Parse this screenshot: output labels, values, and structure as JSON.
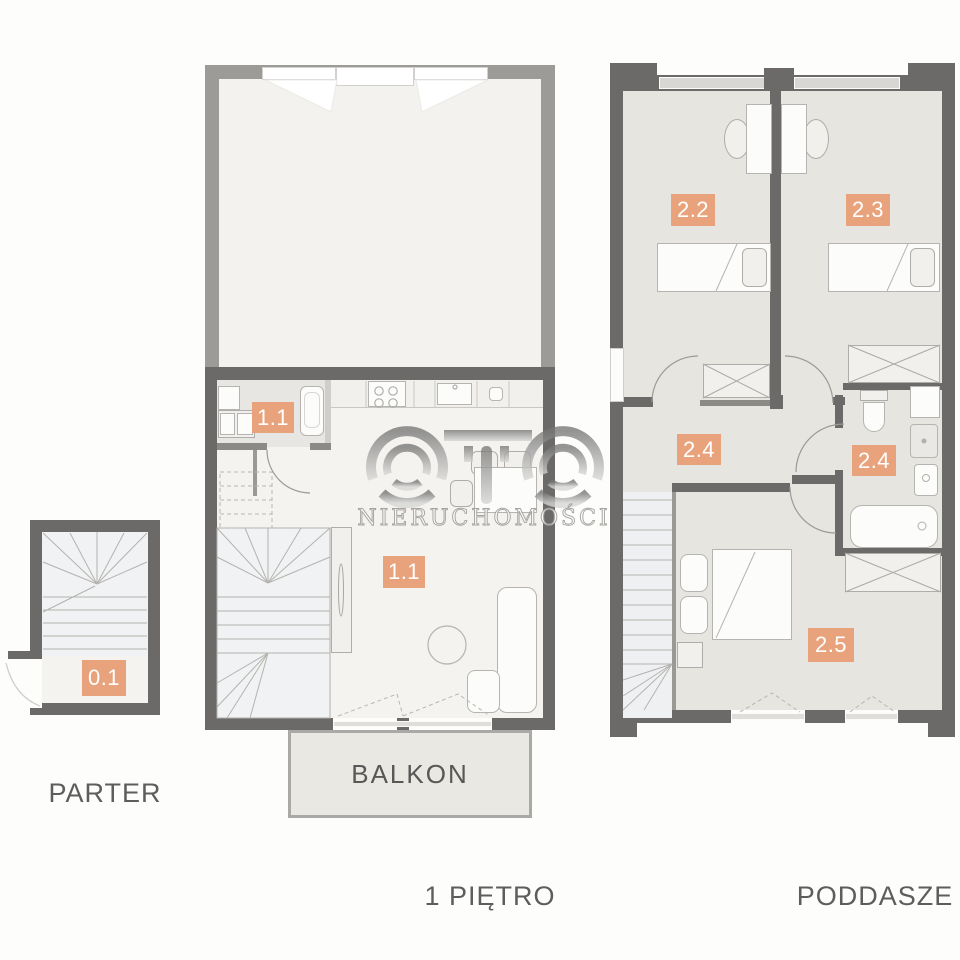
{
  "titles": {
    "parter": "PARTER",
    "first_floor": "1 PIĘTRO",
    "attic": "PODDASZE"
  },
  "balcony": {
    "label": "BALKON"
  },
  "rooms": {
    "parter_entry": "0.1",
    "first_floor_bath": "1.1",
    "first_floor_living": "1.1",
    "attic_bedroom_left": "2.2",
    "attic_bedroom_right": "2.3",
    "attic_hall": "2.4",
    "attic_bathroom": "2.4",
    "attic_bedroom_main": "2.5"
  },
  "watermark": {
    "logo_text": "OTO",
    "subtitle": "NIERUCHOMOŚCI"
  },
  "colors": {
    "badge_bg": "#e9a37c",
    "wall_dark": "#6b6a68",
    "wall_light": "#9c9b98",
    "wall_thin": "#8b8a87",
    "floor_light": "#f5f3f0",
    "floor_attic": "#e6e5e0",
    "label_text": "#5d5d5b"
  }
}
